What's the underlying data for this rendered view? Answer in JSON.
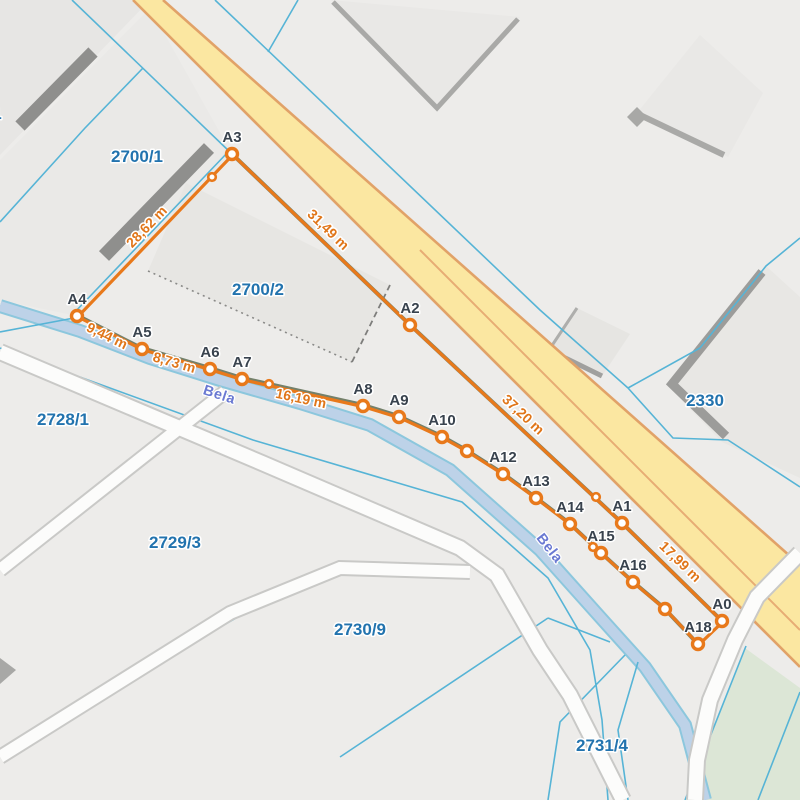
{
  "map": {
    "type": "cadastral-measurement-map",
    "colors": {
      "background": "#edecea",
      "road_fill": "#fbe7a1",
      "road_border": "#e1a268",
      "stream_fill": "#bdd2e8",
      "stream_edge": "#8cc7dd",
      "parcel_line": "#56b4d6",
      "boundary_olive": "#74806a",
      "measure_orange": "#e8791b",
      "parcel_text": "#2273ae",
      "vertex_text": "#39434e",
      "stream_text": "#6a79d2",
      "white_road": "#fcfcfb",
      "green_area": "#dce6d6",
      "building_dark": "#8f8f8d",
      "building_light": "#e9e8e5"
    },
    "parcel_labels": [
      {
        "text": "1",
        "x": -3,
        "y": 119
      },
      {
        "text": "2700/1",
        "x": 137,
        "y": 162
      },
      {
        "text": "2700/2",
        "x": 258,
        "y": 295
      },
      {
        "text": "2728/1",
        "x": 63,
        "y": 425
      },
      {
        "text": "2729/3",
        "x": 175,
        "y": 548
      },
      {
        "text": "2730/9",
        "x": 360,
        "y": 635
      },
      {
        "text": "2731/4",
        "x": 602,
        "y": 751
      },
      {
        "text": "2330",
        "x": 705,
        "y": 406
      }
    ],
    "stream_labels": [
      {
        "text": "Bela",
        "x": 218,
        "y": 399,
        "rot": 18
      },
      {
        "text": "Bela",
        "x": 546,
        "y": 551,
        "rot": 52
      }
    ],
    "measurement": {
      "closed": true,
      "vertices": [
        {
          "name": "A0",
          "x": 722,
          "y": 621,
          "labeled": true
        },
        {
          "name": "A1",
          "x": 622,
          "y": 523,
          "labeled": true
        },
        {
          "name": "A2",
          "x": 410,
          "y": 325,
          "labeled": true
        },
        {
          "name": "A3",
          "x": 232,
          "y": 154,
          "labeled": true
        },
        {
          "name": "A4",
          "x": 77,
          "y": 316,
          "labeled": true
        },
        {
          "name": "A5",
          "x": 142,
          "y": 349,
          "labeled": true
        },
        {
          "name": "A6",
          "x": 210,
          "y": 369,
          "labeled": true
        },
        {
          "name": "A7",
          "x": 242,
          "y": 379,
          "labeled": true
        },
        {
          "name": "A8",
          "x": 363,
          "y": 406,
          "labeled": true
        },
        {
          "name": "A9",
          "x": 399,
          "y": 417,
          "labeled": true
        },
        {
          "name": "A10",
          "x": 442,
          "y": 437,
          "labeled": true
        },
        {
          "name": "A11",
          "x": 467,
          "y": 451,
          "labeled": false
        },
        {
          "name": "A12",
          "x": 503,
          "y": 474,
          "labeled": true
        },
        {
          "name": "A13",
          "x": 536,
          "y": 498,
          "labeled": true
        },
        {
          "name": "A14",
          "x": 570,
          "y": 524,
          "labeled": true
        },
        {
          "name": "A15",
          "x": 601,
          "y": 553,
          "labeled": true
        },
        {
          "name": "A16",
          "x": 633,
          "y": 582,
          "labeled": true
        },
        {
          "name": "A17",
          "x": 665,
          "y": 609,
          "labeled": false
        },
        {
          "name": "A18",
          "x": 698,
          "y": 644,
          "labeled": true
        }
      ],
      "intermediate_nodes": [
        {
          "x": 212,
          "y": 177
        },
        {
          "x": 269,
          "y": 384
        },
        {
          "x": 596,
          "y": 497
        },
        {
          "x": 593,
          "y": 547
        }
      ],
      "olive_chains": [
        [
          "A3",
          "A2",
          "A1",
          "A0"
        ],
        [
          "A4",
          "A5",
          "A6",
          "A7",
          "A8",
          "A9",
          "A10",
          "A11",
          "A12",
          "A13",
          "A14",
          "A15",
          "A16",
          "A17",
          "A18"
        ]
      ],
      "distance_labels": [
        {
          "text": "28,62 m",
          "x": 150,
          "y": 230,
          "rot": -46
        },
        {
          "text": "31,49 m",
          "x": 325,
          "y": 233,
          "rot": 44
        },
        {
          "text": "9,44 m",
          "x": 105,
          "y": 340,
          "rot": 26
        },
        {
          "text": "8,73 m",
          "x": 173,
          "y": 367,
          "rot": 16
        },
        {
          "text": "16,19 m",
          "x": 300,
          "y": 403,
          "rot": 12
        },
        {
          "text": "37,20 m",
          "x": 520,
          "y": 418,
          "rot": 43
        },
        {
          "text": "17,99 m",
          "x": 677,
          "y": 565,
          "rot": 44
        }
      ]
    }
  }
}
